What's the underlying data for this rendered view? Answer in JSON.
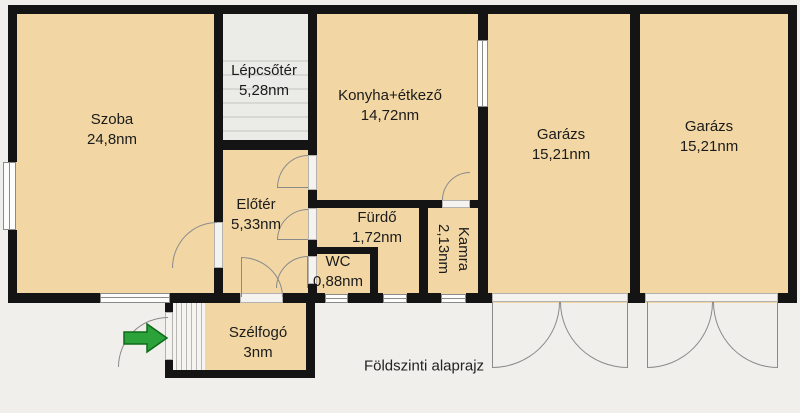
{
  "caption": "Földszinti alaprajz",
  "rooms": [
    {
      "id": "szoba",
      "name": "Szoba",
      "area": "24,8nm"
    },
    {
      "id": "lepcsoter",
      "name": "Lépcsőtér",
      "area": "5,28nm"
    },
    {
      "id": "konyha",
      "name": "Konyha+étkező",
      "area": "14,72nm"
    },
    {
      "id": "garazs-1",
      "name": "Garázs",
      "area": "15,21nm"
    },
    {
      "id": "garazs-2",
      "name": "Garázs",
      "area": "15,21nm"
    },
    {
      "id": "eloter",
      "name": "Előtér",
      "area": "5,33nm"
    },
    {
      "id": "furdo",
      "name": "Fürdő",
      "area": "1,72nm"
    },
    {
      "id": "wc",
      "name": "WC",
      "area": "0,88nm"
    },
    {
      "id": "kamra",
      "name": "Kamra",
      "area": "2,13nm"
    },
    {
      "id": "szelfogo",
      "name": "Szélfogó",
      "area": "3nm"
    }
  ],
  "icons": {
    "entrance_arrow": "right-arrow"
  },
  "colors": {
    "wall": "#141414",
    "room_fill": "#f2d7a4",
    "stairwell_fill": "#ebebe8",
    "outside": "#f0efec",
    "entrance_arrow": "#2ba33a",
    "door_line": "#8a8a8b"
  }
}
